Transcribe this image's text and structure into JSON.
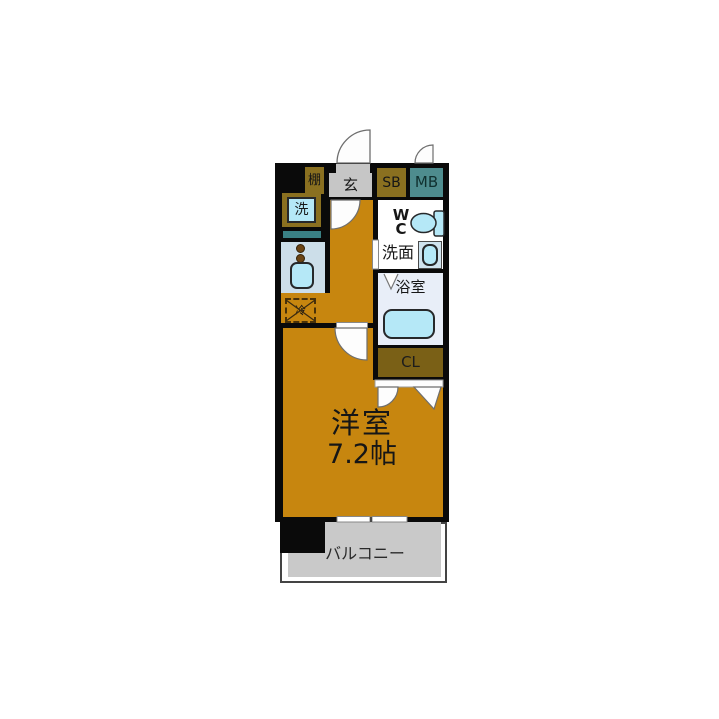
{
  "floor_plan": {
    "entrance": {
      "label": "玄",
      "shelf": "棚",
      "shoe_box": "SB",
      "meter_box": "MB"
    },
    "utility": {
      "washer": "洗",
      "fridge": "冷"
    },
    "sanitary": {
      "wc_line1": "W",
      "wc_line2": "C",
      "washroom": "洗面",
      "bathroom": "浴室"
    },
    "storage": {
      "closet": "CL"
    },
    "main_room": {
      "name": "洋室",
      "size": "7.2帖"
    },
    "balcony": {
      "label": "バルコニー"
    },
    "colors": {
      "wall": "#0a0a0a",
      "floor": "#c7860f",
      "cabinet_olive": "#8a7020",
      "closet_brown": "#7a6016",
      "meter_box_teal": "#4e8c8e",
      "counter_teal": "#3a8084",
      "fixture_blue": "#b5e8f7",
      "kitchen_bg": "#ccdee9",
      "bathroom_bg": "#e8eef8",
      "entrance_gray": "#c6c6c6",
      "balcony_gray": "#c9c9c9"
    }
  }
}
